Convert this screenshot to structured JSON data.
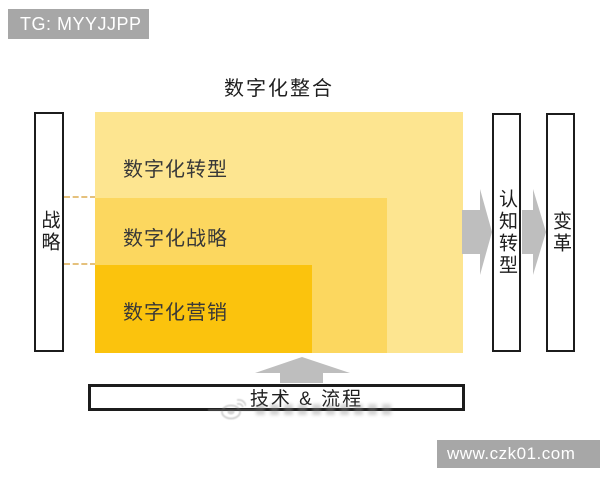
{
  "badges": {
    "tg": "TG: MYYJJPP",
    "website": "www.czk01.com"
  },
  "title": "数字化整合",
  "left_box": {
    "label": "战略"
  },
  "nested_rects": {
    "outer": {
      "label": "数字化转型",
      "color": "#FDE590"
    },
    "middle": {
      "label": "数字化战略",
      "color": "#FCD75F"
    },
    "inner": {
      "label": "数字化营销",
      "color": "#FBC30D"
    }
  },
  "right_flow": {
    "cognition": "认知转型",
    "change": "变革"
  },
  "bottom_box": {
    "label": "技术 & 流程"
  },
  "icons": {
    "watermark": "weibo-icon",
    "arrows": [
      "right-arrow-icon",
      "right-arrow-icon",
      "up-arrow-icon"
    ]
  },
  "colors": {
    "arrow_gray": "#BEBEBE",
    "badge_gray": "#A7A7A7",
    "dashed_connector": "#DFB25C",
    "border_black": "#1C1C1C",
    "background": "#FFFFFF"
  }
}
